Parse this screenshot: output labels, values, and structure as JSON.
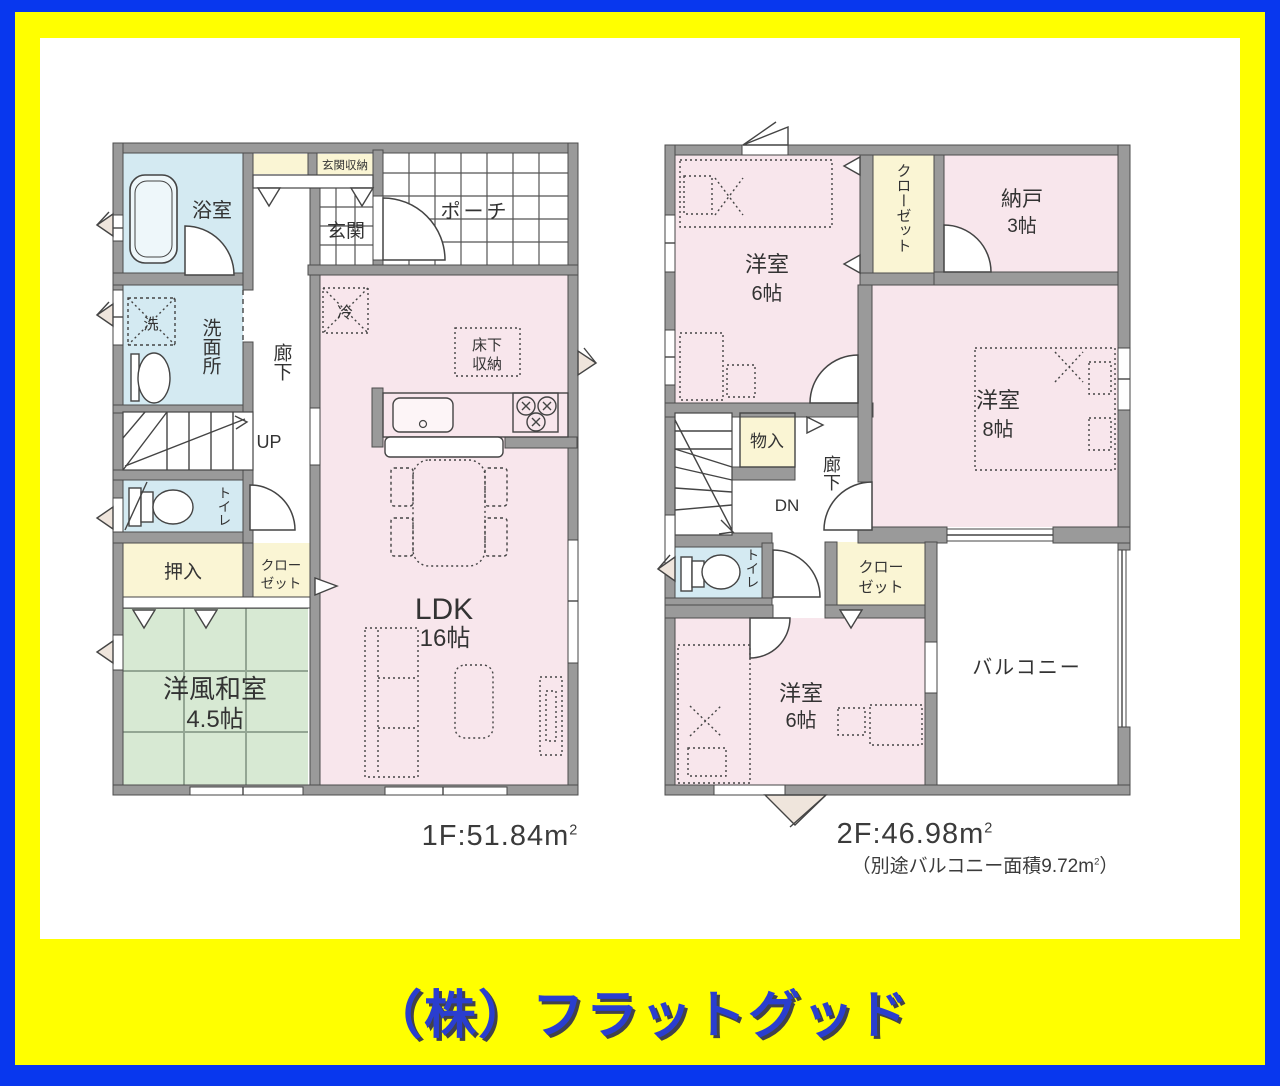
{
  "company": "（株）フラットグッド",
  "colors": {
    "frame_blue": "#0837ee",
    "frame_yellow": "#ffff00",
    "wall_gray": "#9a9a9a",
    "room_pink": "#f8e6ec",
    "room_blue": "#d4eaf2",
    "room_yellow": "#faf5d4",
    "room_green": "#d7e9d3",
    "footer_text_blue": "#2a3ecf"
  },
  "floor1": {
    "area_prefix": "1F:51.84m",
    "area_sup": "2",
    "labels": {
      "bath": "浴室",
      "entrance_storage": "玄関収納",
      "entrance": "玄関",
      "porch": "ポーチ",
      "washer": "洗",
      "washroom": "洗面所",
      "hall": "廊下",
      "up": "UP",
      "toilet": "トイレ",
      "oshiire": "押入",
      "closet_l1": "クロー",
      "closet_l2": "ゼット",
      "tatami_l1": "洋風和室",
      "tatami_l2": "4.5帖",
      "fridge": "冷",
      "underfloor_l1": "床下",
      "underfloor_l2": "収納",
      "ldk_l1": "LDK",
      "ldk_l2": "16帖"
    }
  },
  "floor2": {
    "area_prefix": "2F:46.98m",
    "area_sup": "2",
    "note_prefix": "（別途バルコニー面積9.72m",
    "note_sup": "2",
    "note_suffix": "）",
    "labels": {
      "bedroom6a_l1": "洋室",
      "bedroom6a_l2": "6帖",
      "closet_top": "クローゼット",
      "storage_l1": "納戸",
      "storage_l2": "3帖",
      "bedroom8_l1": "洋室",
      "bedroom8_l2": "8帖",
      "monoire": "物入",
      "hall": "廊下",
      "dn": "DN",
      "toilet": "トイレ",
      "closet_l1": "クロー",
      "closet_l2": "ゼット",
      "bedroom6b_l1": "洋室",
      "bedroom6b_l2": "6帖",
      "balcony": "バルコニー"
    }
  }
}
